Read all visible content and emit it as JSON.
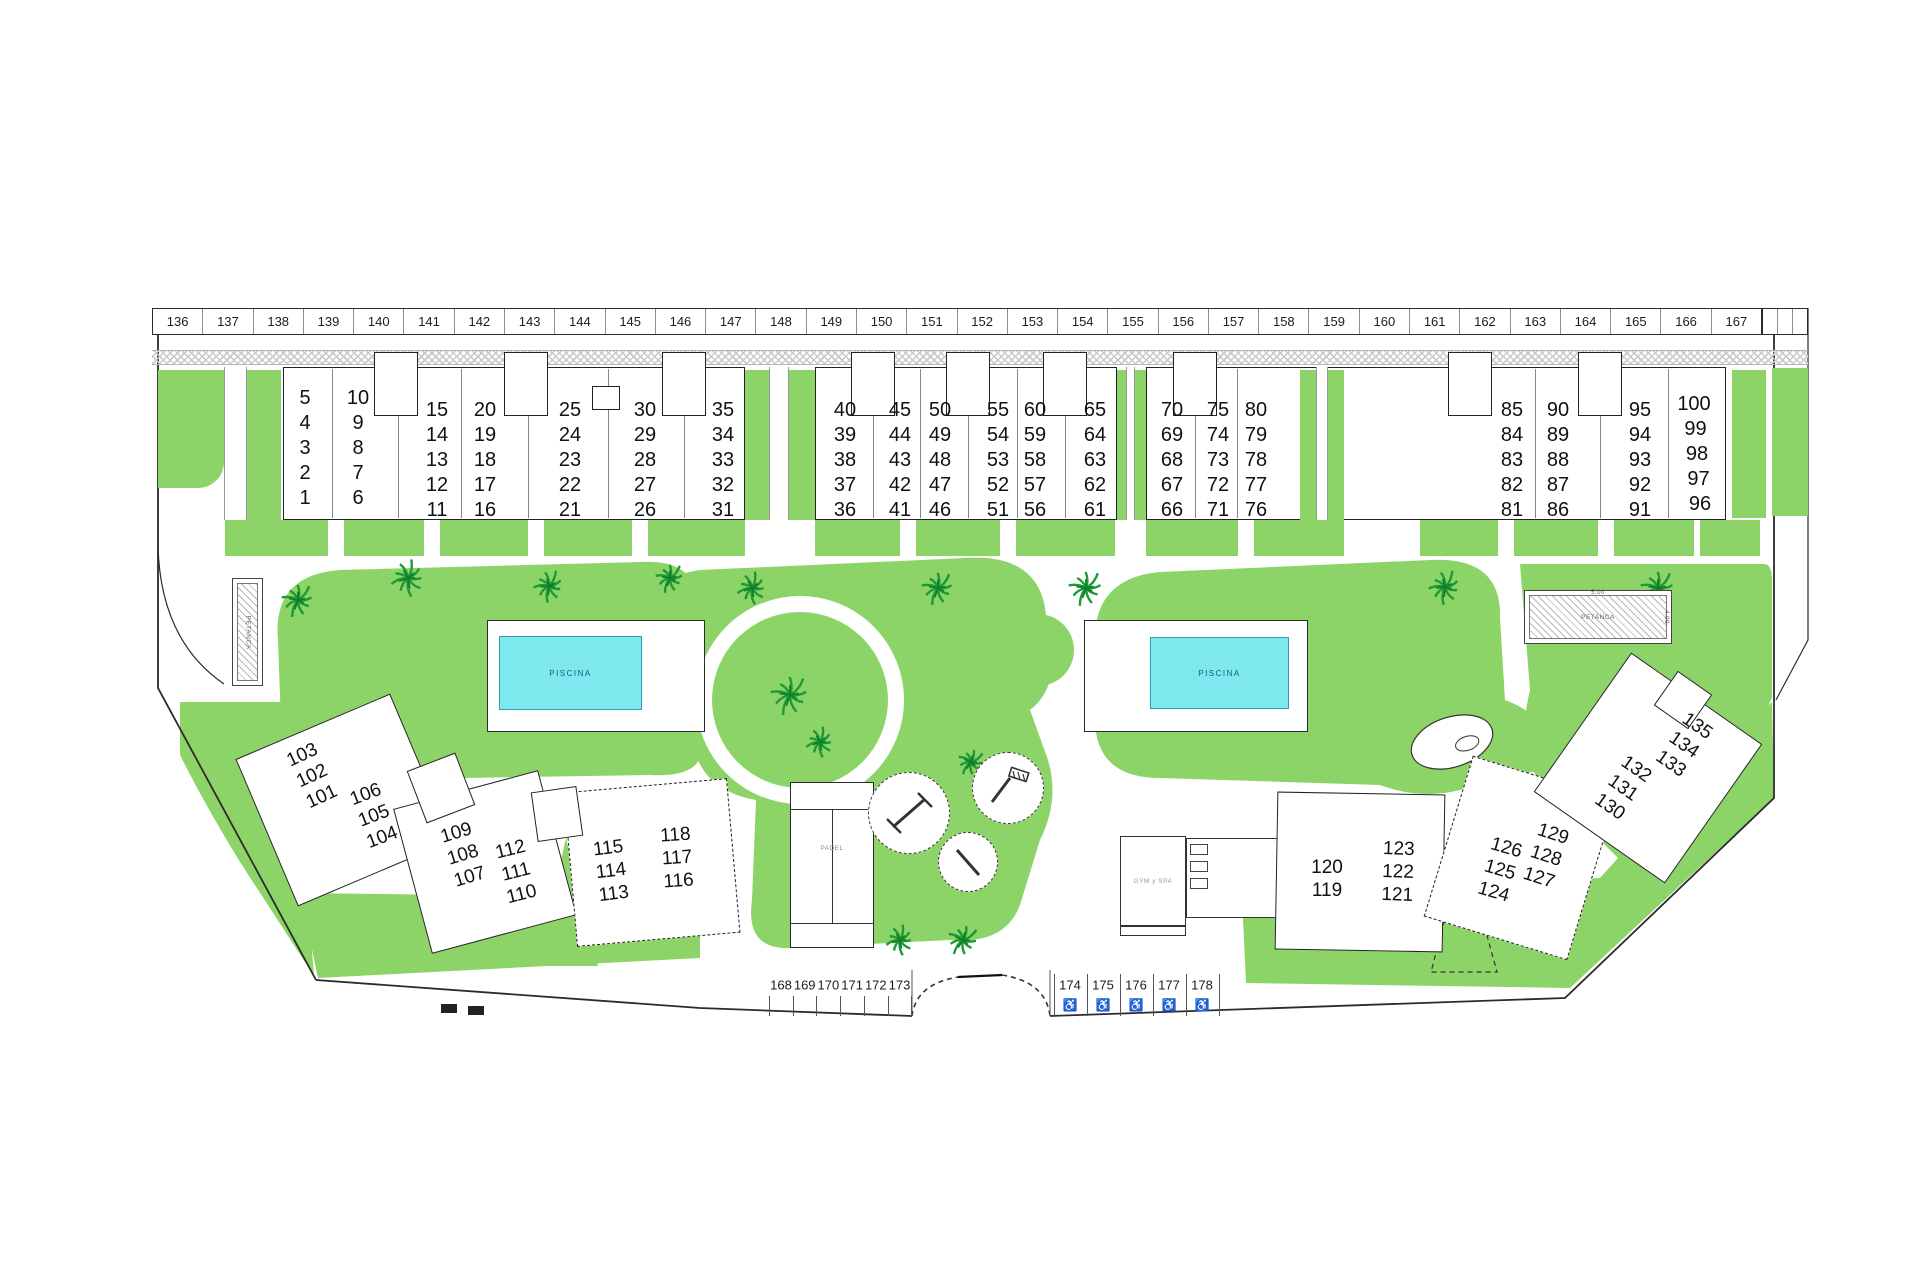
{
  "colors": {
    "green": "#8dd468",
    "pool_water": "#7de9ef",
    "outline": "#222222",
    "hatch_gray": "#c9c9c9",
    "palm_green": "#1d9a35"
  },
  "parking_strip": {
    "spaces": [
      "136",
      "137",
      "138",
      "139",
      "140",
      "141",
      "142",
      "143",
      "144",
      "145",
      "146",
      "147",
      "148",
      "149",
      "150",
      "151",
      "152",
      "153",
      "154",
      "155",
      "156",
      "157",
      "158",
      "159",
      "160",
      "161",
      "162",
      "163",
      "164",
      "165",
      "166",
      "167"
    ]
  },
  "top_buildings": [
    {
      "columns": [
        [
          "5",
          "4",
          "3",
          "2",
          "1"
        ],
        [
          "10",
          "9",
          "8",
          "7",
          "6"
        ],
        [
          "15",
          "14",
          "13",
          "12",
          "11"
        ],
        [
          "20",
          "19",
          "18",
          "17",
          "16"
        ],
        [
          "25",
          "24",
          "23",
          "22",
          "21"
        ],
        [
          "30",
          "29",
          "28",
          "27",
          "26"
        ],
        [
          "35",
          "34",
          "33",
          "32",
          "31"
        ]
      ]
    },
    {
      "columns": [
        [
          "40",
          "39",
          "38",
          "37",
          "36"
        ],
        [
          "45",
          "44",
          "43",
          "42",
          "41"
        ],
        [
          "50",
          "49",
          "48",
          "47",
          "46"
        ],
        [
          "55",
          "54",
          "53",
          "52",
          "51"
        ],
        [
          "60",
          "59",
          "58",
          "57",
          "56"
        ],
        [
          "65",
          "64",
          "63",
          "62",
          "61"
        ]
      ]
    },
    {
      "columns": [
        [
          "70",
          "69",
          "68",
          "67",
          "66"
        ],
        [
          "75",
          "74",
          "73",
          "72",
          "71"
        ],
        [
          "80",
          "79",
          "78",
          "77",
          "76"
        ],
        [
          "85",
          "84",
          "83",
          "82",
          "81"
        ],
        [
          "90",
          "89",
          "88",
          "87",
          "86"
        ],
        [
          "95",
          "94",
          "93",
          "92",
          "91"
        ],
        [
          "100",
          "99",
          "98",
          "97",
          "96"
        ]
      ]
    }
  ],
  "lower_left_buildings": [
    [
      "103",
      "102",
      "101"
    ],
    [
      "106",
      "105",
      "104"
    ],
    [
      "109",
      "108",
      "107"
    ],
    [
      "112",
      "111",
      "110"
    ],
    [
      "115",
      "114",
      "113"
    ],
    [
      "118",
      "117",
      "116"
    ]
  ],
  "lower_right_buildings": [
    [
      "120",
      "119"
    ],
    [
      "123",
      "122",
      "121"
    ],
    [
      "126",
      "125",
      "124"
    ],
    [
      "129",
      "128",
      "127"
    ],
    [
      "132",
      "131",
      "130"
    ],
    [
      "135",
      "134",
      "133"
    ]
  ],
  "bottom_parking": {
    "spaces": [
      "168",
      "169",
      "170",
      "171",
      "172",
      "173"
    ],
    "accessible_spaces": [
      "174",
      "175",
      "176",
      "177",
      "178"
    ],
    "accessible_symbol": "♿"
  },
  "labels": {
    "pool": "PISCINA",
    "padel": "PADEL",
    "petanca": "PETANCA",
    "gym": "GYM y SPA",
    "petanca_width": "5.00",
    "petanca_height": "4.00"
  }
}
